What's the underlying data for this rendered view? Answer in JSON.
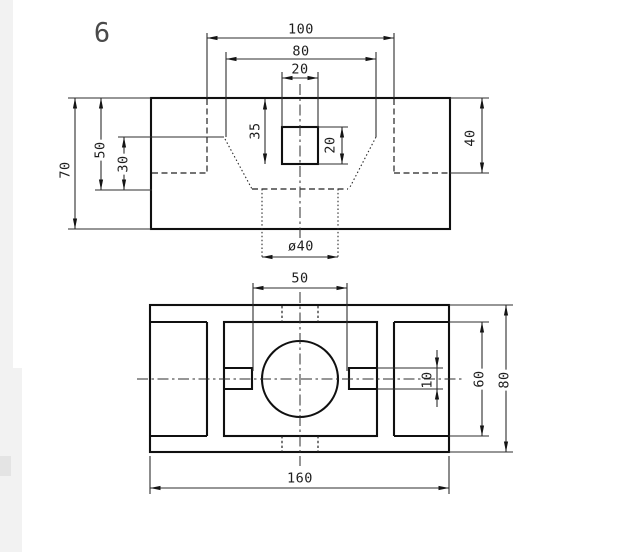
{
  "sheet": {
    "drawing_number": "6"
  },
  "colors": {
    "ink": "#101010",
    "thin_line": "#2e2e2e",
    "canvas": "#ffffff",
    "gutter": "#f2f2f2"
  },
  "front_view": {
    "dim_width_100": "100",
    "dim_width_80": "80",
    "dim_square_width_20": "20",
    "dim_height_70": "70",
    "dim_depth_50": "50",
    "dim_depth_30": "30",
    "dim_square_depth_35": "35",
    "dim_square_height_20": "20",
    "dim_recess_depth_40": "40",
    "dim_hole_dia": "ø40"
  },
  "plan_view": {
    "dim_slot_span_50": "50",
    "dim_slot_width_10": "10",
    "dim_pocket_width_60": "60",
    "dim_overall_depth_80": "80",
    "dim_overall_width_160": "160"
  }
}
